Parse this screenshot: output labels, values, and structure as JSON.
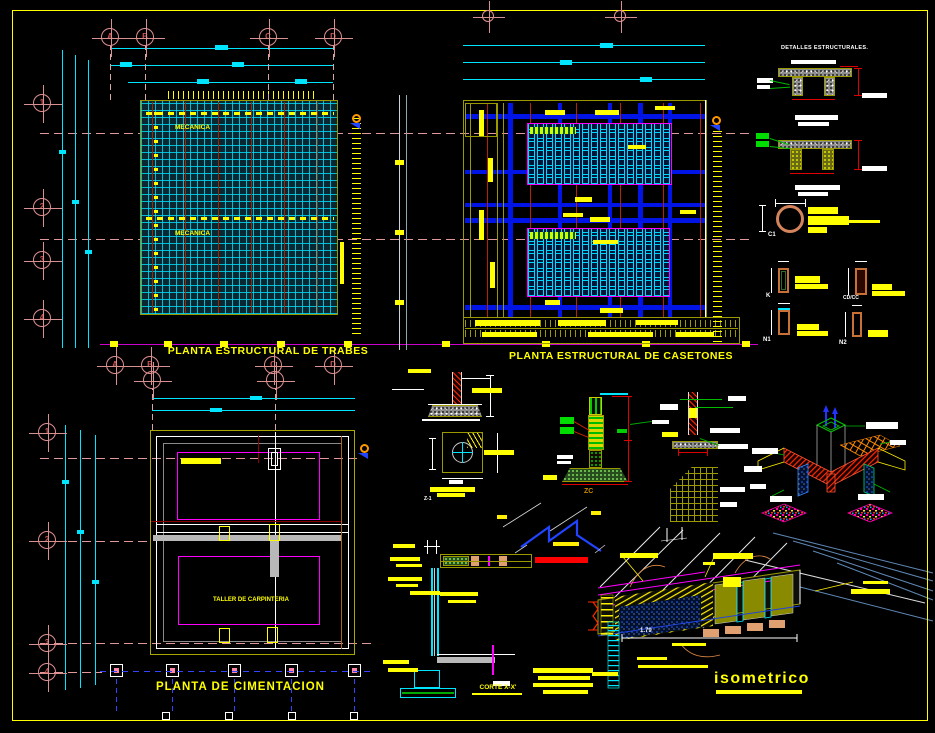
{
  "sheet": {
    "background": "#000000",
    "border_color": "#ffff00"
  },
  "titles": {
    "plan_trabes": "PLANTA ESTRUCTURAL DE TRABES",
    "plan_casetones": "PLANTA ESTRUCTURAL DE CASETONES",
    "plan_cimentacion": "PLANTA DE CIMENTACION",
    "isometric": "isometrico",
    "corte": "CORTE X-X'",
    "detalles": "DETALLES ESTRUCTURALES."
  },
  "room_labels": {
    "mecanica_top": "MECANICA",
    "mecanica_bottom": "MECANICA",
    "taller": "TALLER DE CARPINTERIA"
  },
  "detail_labels": {
    "c1": "C1",
    "k": "K",
    "cdcc": "CD/CC",
    "n1": "N1",
    "n2": "N2",
    "z1": "Z-1",
    "zc": "ZC"
  },
  "dimensions": {
    "iso_length": "1.79"
  },
  "grid_bubbles": {
    "plan1_top": [
      "A",
      "B",
      "C",
      "D"
    ],
    "plan1_bottom": [
      "A",
      "B",
      "C",
      "D"
    ],
    "plan1_left": [
      "1",
      "2",
      "3",
      "4"
    ],
    "plan3_left": [
      "1",
      "2",
      "3",
      "4"
    ]
  },
  "colors": {
    "dimension": "#00ffff",
    "axis_bubble": "#f0a0a0",
    "beam_blue": "#0014e6",
    "caseton_cyan": "#00d8ff",
    "outline_olive": "#9a9a00",
    "text_yellow": "#ffff00",
    "section_magenta": "#ff00ff"
  }
}
